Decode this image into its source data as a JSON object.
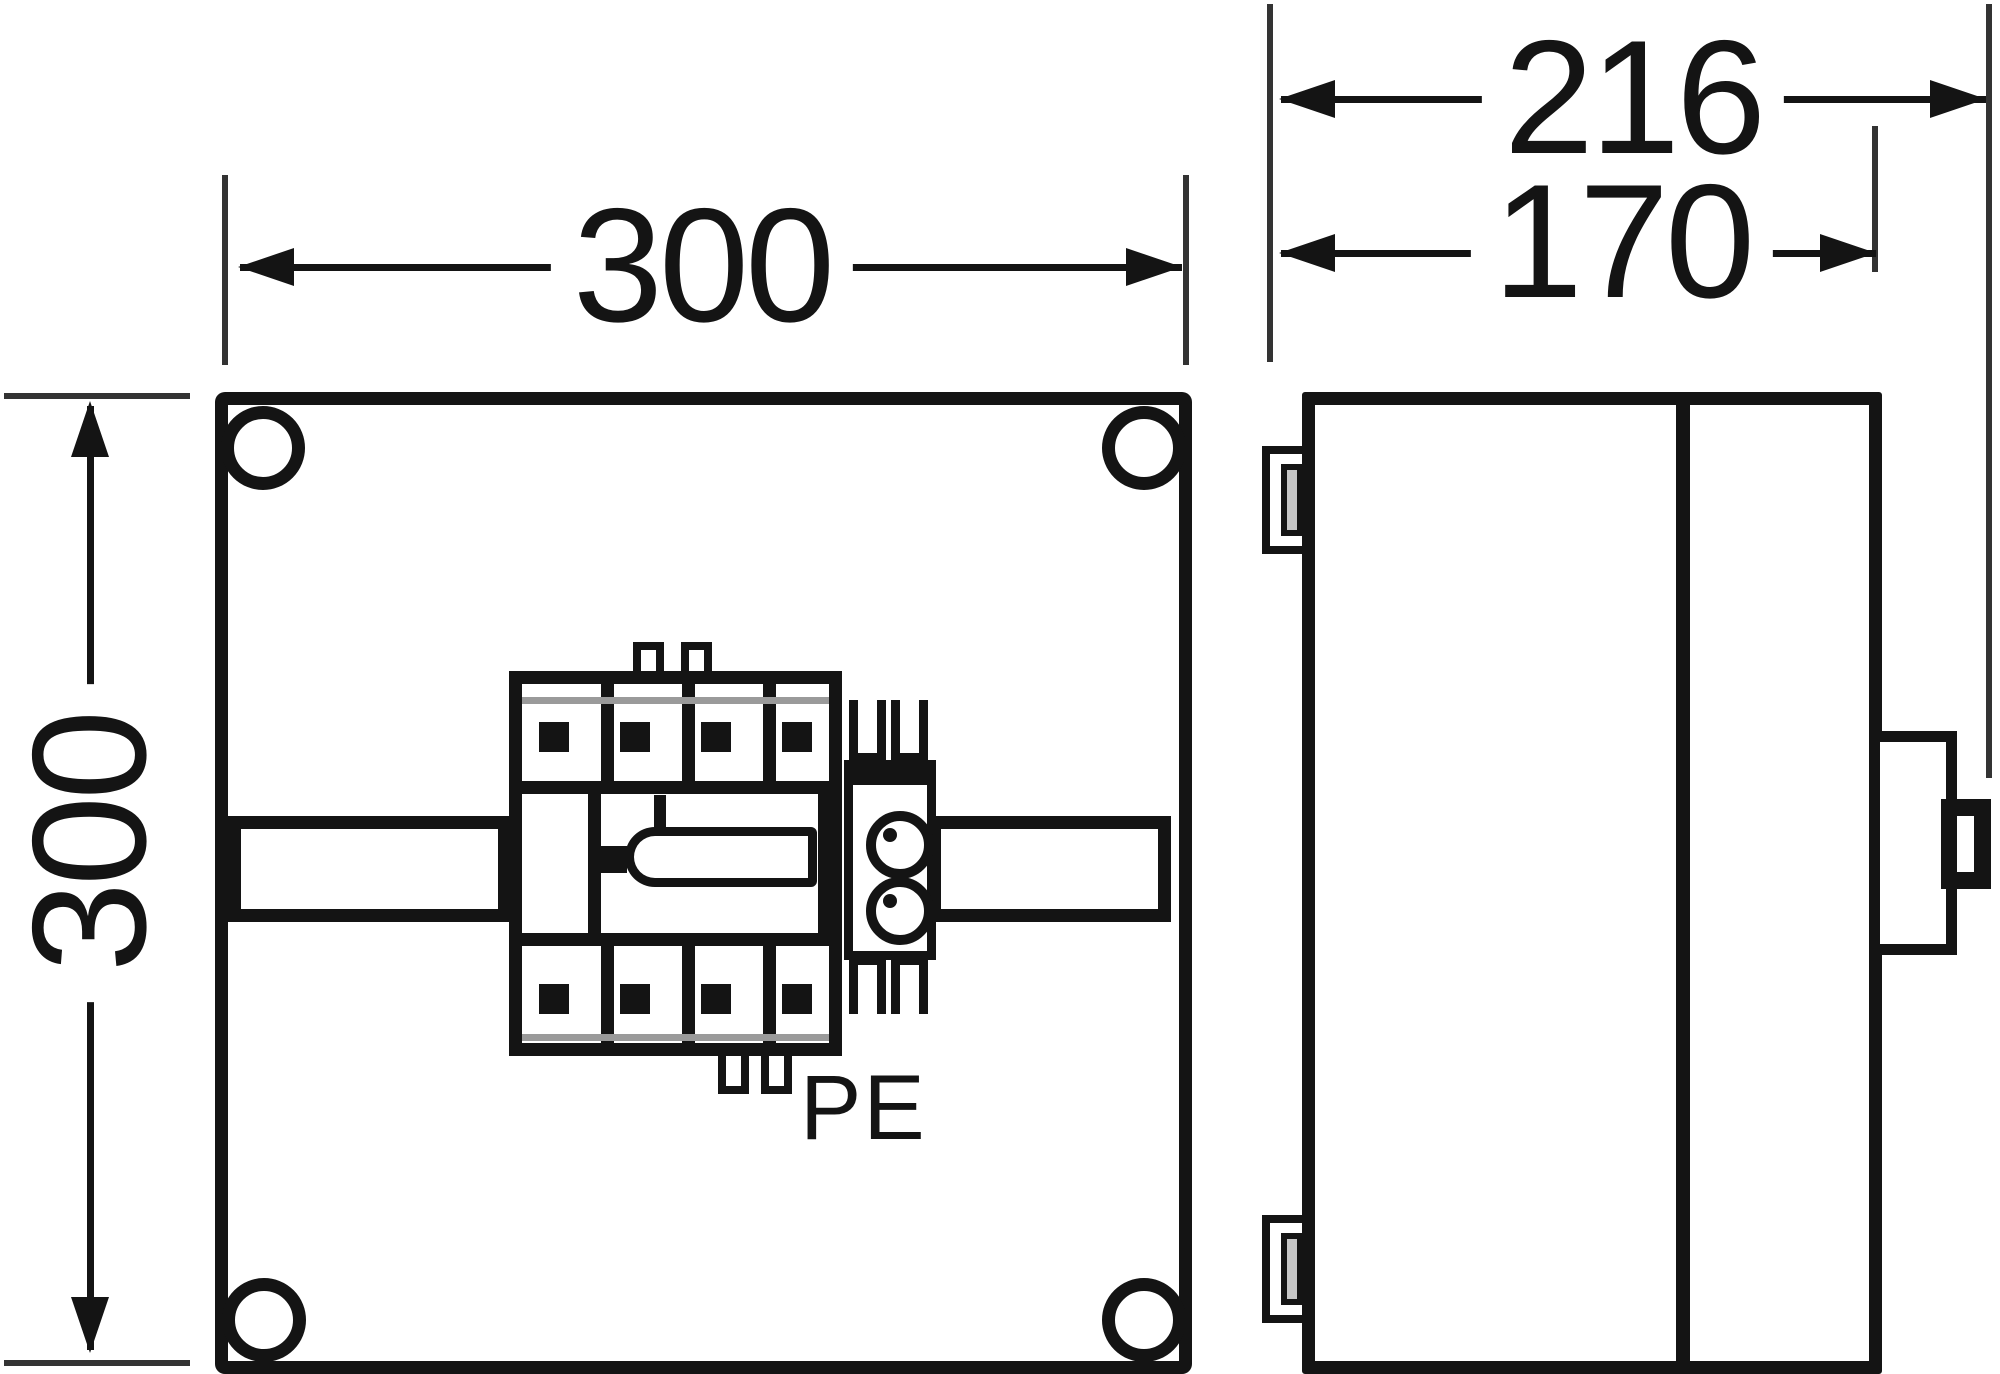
{
  "drawing_title": "Enclosure dimension drawing, front and side view",
  "dimensions": {
    "front_width_mm": "300",
    "front_height_mm": "300",
    "overall_depth_mm": "216",
    "base_depth_mm": "170"
  },
  "labels": {
    "pe_terminal": "PE"
  },
  "colors": {
    "line": "#141414",
    "extension_line": "#333333",
    "accent_gray": "#9a9a9a",
    "slot_gray": "#c6c6c6",
    "background": "#ffffff"
  }
}
